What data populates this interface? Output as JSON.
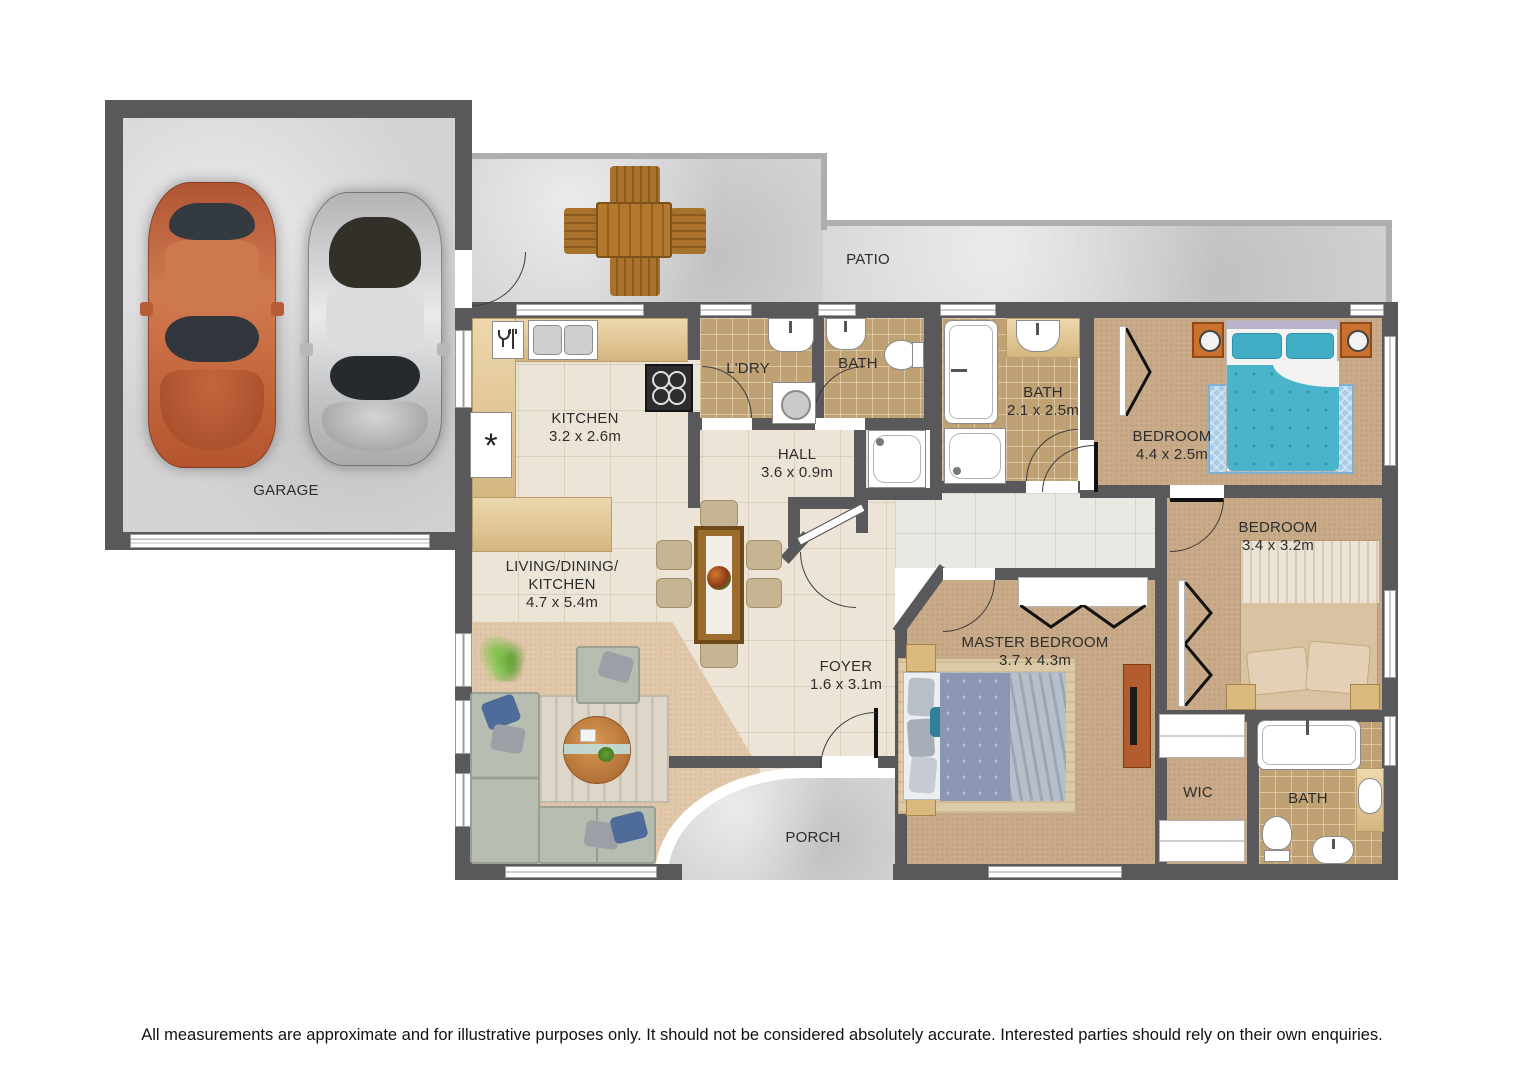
{
  "rooms": {
    "garage": {
      "name": "GARAGE"
    },
    "patio": {
      "name": "PATIO"
    },
    "kitchen": {
      "name": "KITCHEN",
      "dims": "3.2 x 2.6m"
    },
    "laundry": {
      "name": "L'DRY"
    },
    "bath_top": {
      "name": "BATH"
    },
    "hall": {
      "name": "HALL",
      "dims": "3.6 x 0.9m"
    },
    "bath_main": {
      "name": "BATH",
      "dims": "2.1 x 2.5m"
    },
    "bedroom_top": {
      "name": "BEDROOM",
      "dims": "4.4 x 2.5m"
    },
    "bedroom_right": {
      "name": "BEDROOM",
      "dims": "3.4 x 3.2m"
    },
    "living": {
      "line1": "LIVING/DINING/",
      "line2": "KITCHEN",
      "dims": "4.7 x 5.4m"
    },
    "foyer": {
      "name": "FOYER",
      "dims": "1.6 x 3.1m"
    },
    "master": {
      "name": "MASTER BEDROOM",
      "dims": "3.7 x 4.3m"
    },
    "wic": {
      "name": "WIC"
    },
    "bath_ensuite": {
      "name": "BATH"
    },
    "porch": {
      "name": "PORCH"
    }
  },
  "symbols": {
    "fridge": "*"
  },
  "colors": {
    "wall": "#59595b",
    "bath_tile": "#bfa174",
    "carpet": "#c9ab8a",
    "teal_bed": "#49b4ca",
    "orange_car": "#c96a45",
    "silver_car": "#c9cacc"
  },
  "disclaimer": "All measurements are approximate and for illustrative purposes only. It should not be considered absolutely accurate. Interested parties should rely on their own enquiries."
}
